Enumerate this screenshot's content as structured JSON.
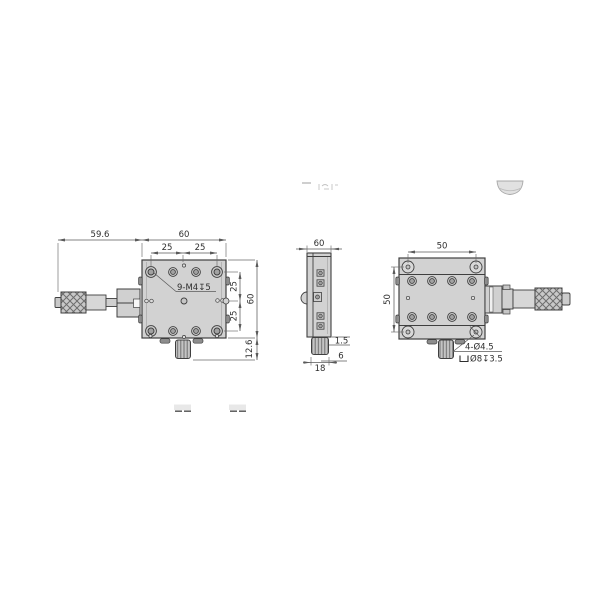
{
  "drawing_title": "linear translation stage dimensional drawing",
  "views": {
    "front": {
      "dim_micrometer_length": "59.6",
      "dim_body_width": "60",
      "dim_hole_pitch_top_left": "25",
      "dim_hole_pitch_top_right": "25",
      "dim_hole_pitch_right_upper": "25",
      "dim_hole_pitch_right_lower": "25",
      "dim_body_height": "60",
      "dim_knob_height": "12.6",
      "thread_note": "9-M4↧5"
    },
    "side": {
      "dim_depth": "60",
      "dim_plate_clearance": "1.5",
      "dim_knob_step": "6",
      "dim_knob_width": "18"
    },
    "back": {
      "dim_hole_pitch_horizontal": "50",
      "dim_hole_pitch_vertical": "50",
      "mount_note_line1": "4-Ø4.5",
      "mount_note_line2": "Ø8↧3.5"
    }
  },
  "colors": {
    "body_fill": "#d2d2d2",
    "outline": "#3f3f3f",
    "dimension": "#5a5a5a",
    "background": "#ffffff"
  }
}
